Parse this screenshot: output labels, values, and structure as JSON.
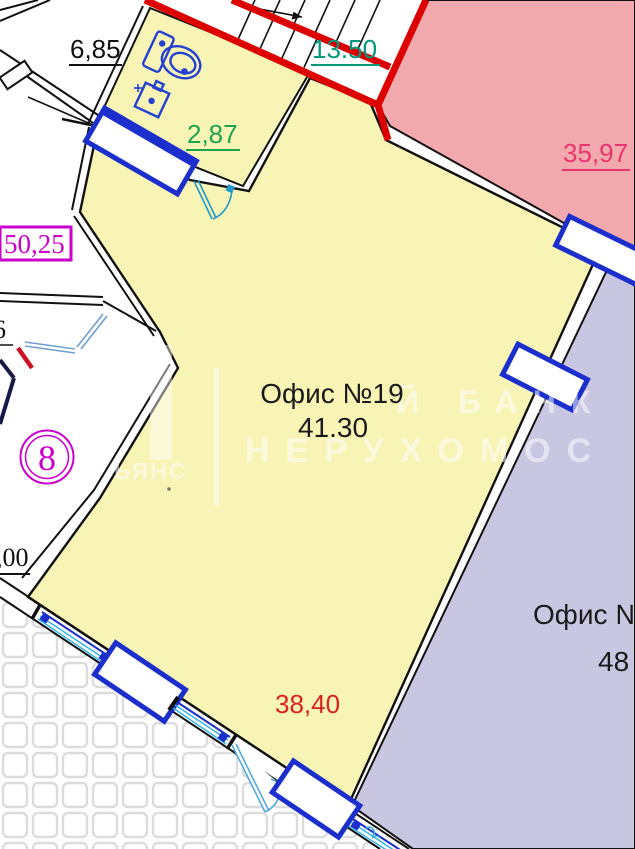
{
  "plan": {
    "rooms": {
      "office19": {
        "name": "Офис №19",
        "area": "41.30"
      },
      "office_right": {
        "name": "Офис №",
        "area": "48"
      },
      "pink_room_area": "35,97",
      "stairwell_area": "13.50",
      "bathroom_area": "2,87",
      "top_left_room_area": "6,85",
      "boxed_unit_area": "50,25",
      "unit_number": "8",
      "bottom_area": "38,40",
      "partial_left_area": ",00",
      "partial_left_small": "6"
    },
    "watermark": {
      "side_text": "ЬЯНС",
      "line1": "Й БАНК",
      "line2": "НЕРУХОМОС"
    },
    "colors": {
      "room_yellow": "#f8f4b6",
      "room_pink": "#f2a9ae",
      "room_lavender": "#c9c6e2",
      "outline_red": "#dc0000",
      "magenta": "#cc00cc",
      "green": "#1ea34c",
      "teal": "#00997a",
      "crimson_pink": "#e8356d",
      "label_red": "#dd2020",
      "fixture_blue": "#1c2fcc",
      "door_cyan": "#3aa9d6",
      "wall_black": "#111111"
    }
  }
}
